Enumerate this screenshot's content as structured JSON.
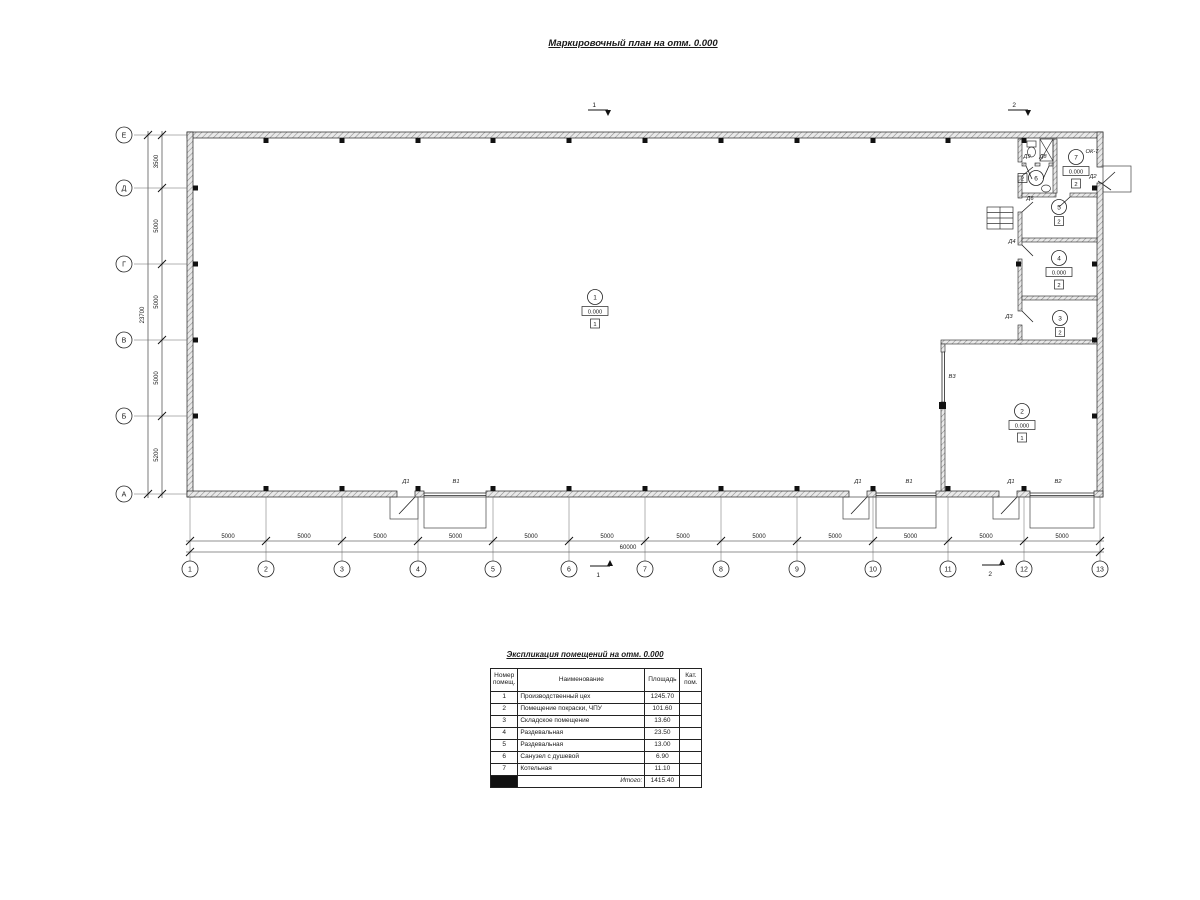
{
  "page_title": "Маркировочный план на отм. 0.000",
  "plan": {
    "axis_rows": [
      "Е",
      "Д",
      "Г",
      "В",
      "Б",
      "А"
    ],
    "axis_cols": [
      "1",
      "2",
      "3",
      "4",
      "5",
      "6",
      "7",
      "8",
      "9",
      "10",
      "11",
      "12",
      "13"
    ],
    "dims_left": [
      "3500",
      "5000",
      "5000",
      "5000",
      "5200"
    ],
    "dims_left_total": "23700",
    "dims_bottom": [
      "5000",
      "5000",
      "5000",
      "5000",
      "5000",
      "5000",
      "5000",
      "5000",
      "5000",
      "5000",
      "5000",
      "5000"
    ],
    "dims_bottom_total": "60000",
    "section_marks": [
      "1",
      "2"
    ],
    "rooms": [
      {
        "num": "1",
        "elevation": "0.000",
        "cat": "1"
      },
      {
        "num": "2",
        "elevation": "0.000",
        "cat": "1"
      },
      {
        "num": "3",
        "elevation": "",
        "cat": "2"
      },
      {
        "num": "4",
        "elevation": "0.000",
        "cat": "2"
      },
      {
        "num": "5",
        "elevation": "",
        "cat": "2"
      },
      {
        "num": "6",
        "elevation": "",
        "cat": "2"
      },
      {
        "num": "7",
        "elevation": "0.000",
        "cat": "2"
      }
    ],
    "labels": {
      "d1": "Д1",
      "d2": "Д2",
      "d3": "Д3",
      "d4": "Д4",
      "d6": "Д6",
      "d8": "Д8",
      "d9": "Д9",
      "v1": "В1",
      "v2": "В2",
      "v3": "В3",
      "ok7": "ОК-7"
    }
  },
  "schedule": {
    "title": "Экспликация помещений на отм. 0.000",
    "headers": [
      "Номер помещ.",
      "Наименование",
      "Площадь",
      "Кат. пом."
    ],
    "rows": [
      [
        "1",
        "Производственный цех",
        "1245.70",
        ""
      ],
      [
        "2",
        "Помещение покраски, ЧПУ",
        "101.60",
        ""
      ],
      [
        "3",
        "Складское помещение",
        "13.60",
        ""
      ],
      [
        "4",
        "Раздевальная",
        "23.50",
        ""
      ],
      [
        "5",
        "Раздевальная",
        "13.00",
        ""
      ],
      [
        "6",
        "Санузел с душевой",
        "6.90",
        ""
      ],
      [
        "7",
        "Котельная",
        "11.10",
        ""
      ]
    ],
    "total_label": "Итого:",
    "total_value": "1415.40"
  }
}
